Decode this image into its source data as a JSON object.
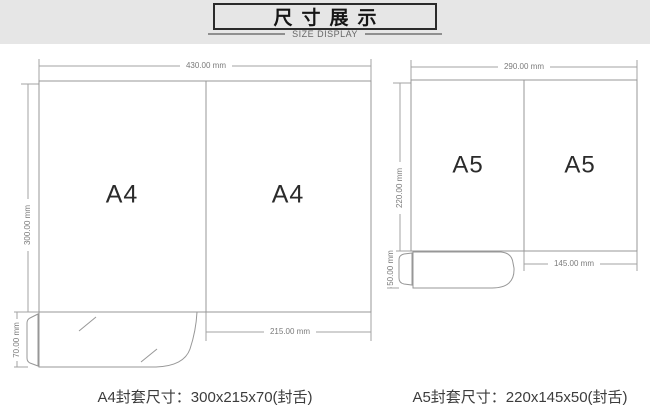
{
  "header": {
    "title": "尺寸展示",
    "subtitle": "SIZE DISPLAY"
  },
  "a4": {
    "label_left": "A4",
    "label_right": "A4",
    "dim_width": "430.00 mm",
    "dim_height": "300.00 mm",
    "dim_flap": "70.00 mm",
    "dim_panel": "215.00 mm",
    "caption": "A4封套尺寸：300x215x70(封舌)"
  },
  "a5": {
    "label_left": "A5",
    "label_right": "A5",
    "dim_width": "290.00 mm",
    "dim_height": "220.00 mm",
    "dim_flap": "50.00 mm",
    "dim_panel": "145.00 mm",
    "caption": "A5封套尺寸：220x145x50(封舌)"
  },
  "colors": {
    "band": "#e6e6e6",
    "box_border": "#2b2b2b",
    "line": "#979797",
    "dimline": "#a3a3a3",
    "dim_text": "#7a7a7a",
    "label_text": "#2b2b2b",
    "caption_text": "#3c3c3c"
  }
}
